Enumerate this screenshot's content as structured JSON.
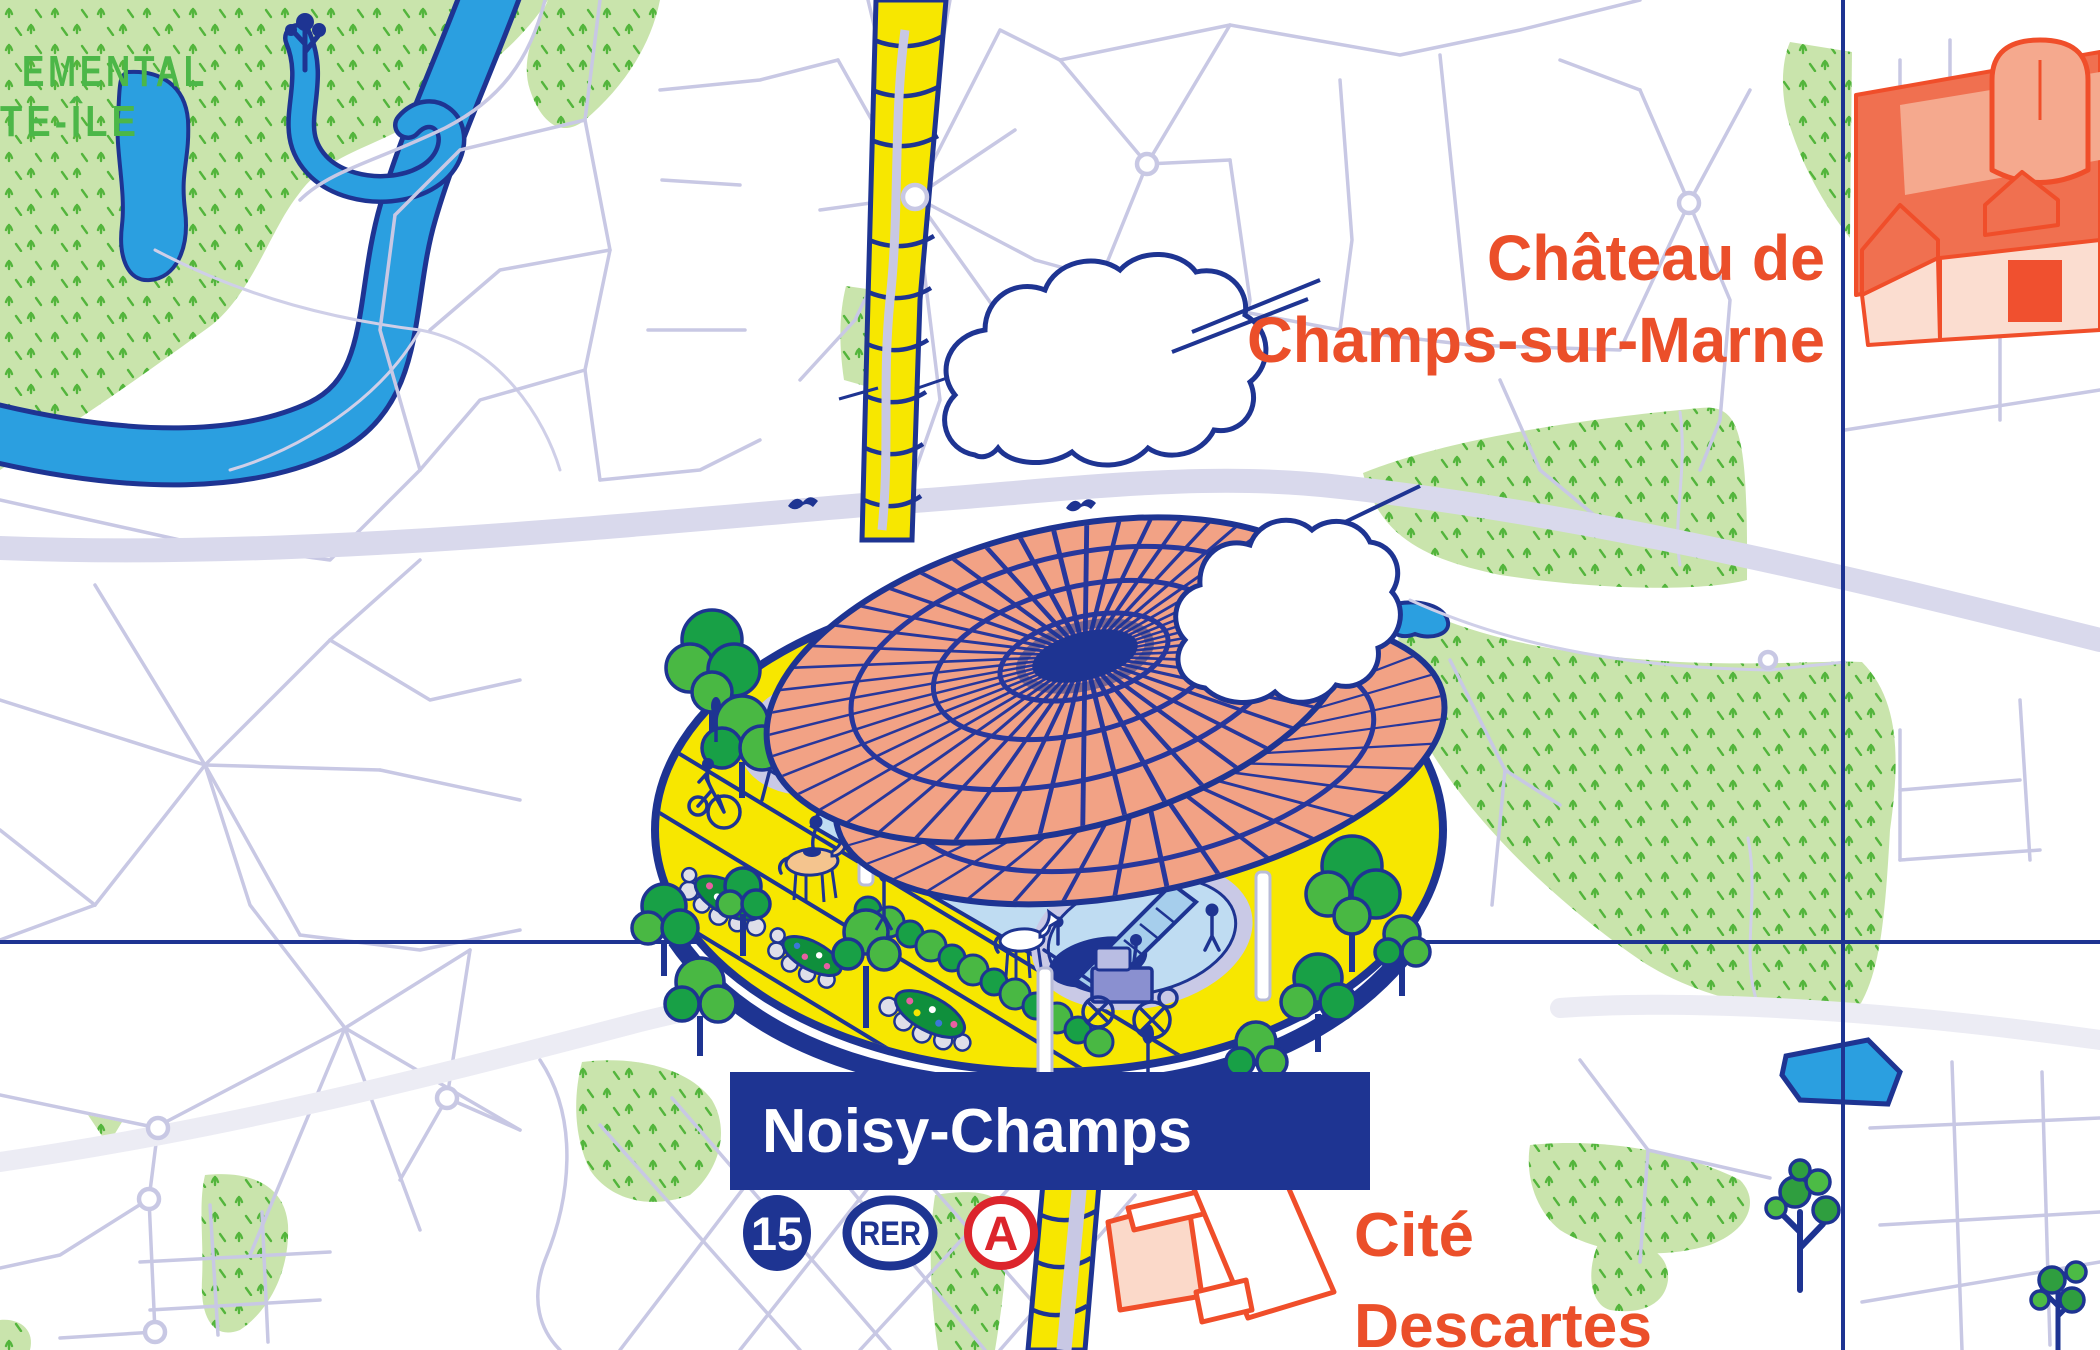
{
  "map": {
    "park": {
      "label_line1": "EMENTAL",
      "label_line2": "TE-ÎLE"
    },
    "chateau": {
      "label_line1": "Château de",
      "label_line2": "Champs-sur-Marne"
    },
    "cite": {
      "label_line1": "Cité",
      "label_line2": "Descartes"
    },
    "station": {
      "name": "Noisy-Champs",
      "badge_metro": "15",
      "badge_rer": "RER",
      "badge_rer_line": "A"
    },
    "colors": {
      "navy": "#1E3492",
      "orange_text": "#EB4F2A",
      "building_orange": "#F04E2A",
      "rer_a_red": "#DC252C",
      "yellow": "#F7E700",
      "roof_salmon": "#F2A285",
      "park_green": "#C9E4AC",
      "grass_green": "#53B53C",
      "water_blue": "#2B9FE0",
      "street_lavender": "#C8C8E4"
    }
  }
}
